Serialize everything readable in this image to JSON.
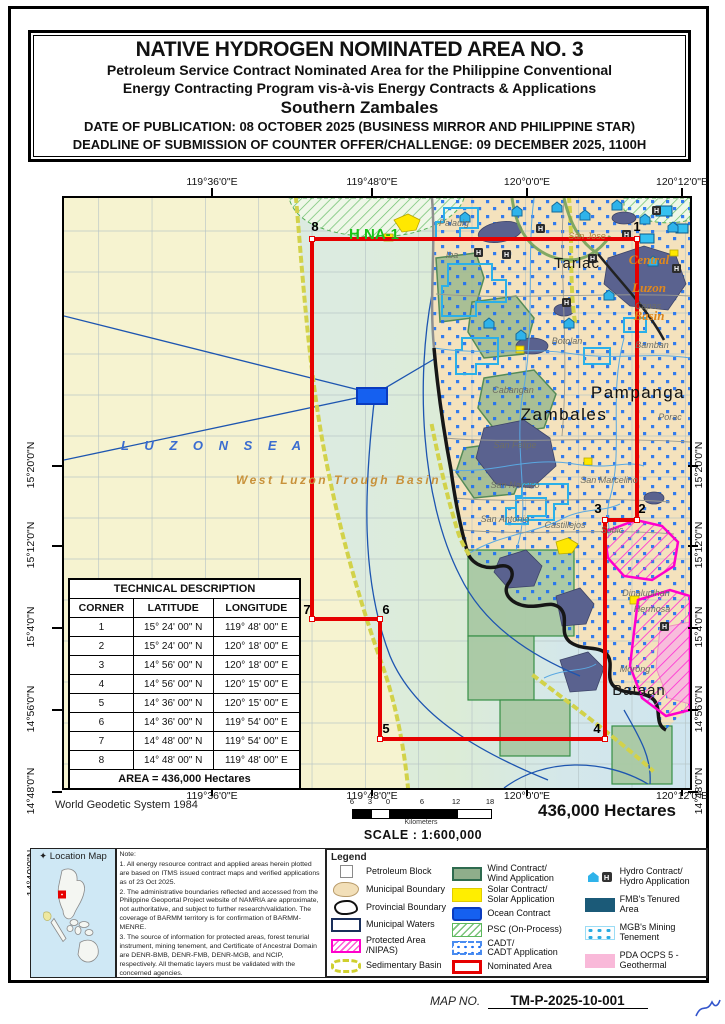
{
  "title_block": {
    "line1": "NATIVE HYDROGEN NOMINATED AREA NO. 3",
    "line2": "Petroleum Service Contract Nominated Area for the Philippine Conventional",
    "line3": "Energy Contracting Program vis-à-vis Energy Contracts & Applications",
    "line4": "Southern Zambales",
    "line5": "DATE OF PUBLICATION: 08 OCTOBER 2025 (BUSINESS MIRROR AND PHILIPPINE STAR)",
    "line6": "DEADLINE OF SUBMISSION OF COUNTER OFFER/CHALLENGE: 09 DECEMBER 2025, 1100H"
  },
  "map": {
    "axis": {
      "top": [
        {
          "x": 150,
          "label": "119°36'0\"E"
        },
        {
          "x": 310,
          "label": "119°48'0\"E"
        },
        {
          "x": 465,
          "label": "120°0'0\"E"
        },
        {
          "x": 620,
          "label": "120°12'0\"E"
        }
      ],
      "bottom": [
        {
          "x": 150,
          "label": "119°36'0\"E"
        },
        {
          "x": 310,
          "label": "119°48'0\"E"
        },
        {
          "x": 465,
          "label": "120°0'0\"E"
        },
        {
          "x": 620,
          "label": "120°12'0\"E"
        }
      ],
      "left": [
        {
          "y": 270,
          "label": "15°20'0\"N"
        },
        {
          "y": 350,
          "label": "15°12'0\"N"
        },
        {
          "y": 432,
          "label": "15°4'0\"N"
        },
        {
          "y": 514,
          "label": "14°56'0\"N"
        },
        {
          "y": 596,
          "label": "14°48'0\"N"
        },
        {
          "y": 678,
          "label": "14°40'0\"N"
        }
      ],
      "right": [
        {
          "y": 270,
          "label": "15°20'0\"N"
        },
        {
          "y": 350,
          "label": "15°12'0\"N"
        },
        {
          "y": 432,
          "label": "15°4'0\"N"
        },
        {
          "y": 514,
          "label": "14°56'0\"N"
        },
        {
          "y": 596,
          "label": "14°48'0\"N"
        },
        {
          "y": 678,
          "label": "14°40'0\"N"
        }
      ]
    },
    "corners": [
      {
        "n": "8",
        "vx": 248,
        "vy": 41,
        "lx": 251,
        "ly": 33
      },
      {
        "n": "1",
        "vx": 573,
        "vy": 41,
        "lx": 573,
        "ly": 33
      },
      {
        "n": "2",
        "vx": 573,
        "vy": 322,
        "lx": 578,
        "ly": 315
      },
      {
        "n": "3",
        "vx": 541,
        "vy": 322,
        "lx": 534,
        "ly": 315
      },
      {
        "n": "4",
        "vx": 541,
        "vy": 541,
        "lx": 533,
        "ly": 535
      },
      {
        "n": "5",
        "vx": 316,
        "vy": 541,
        "lx": 322,
        "ly": 535
      },
      {
        "n": "6",
        "vx": 316,
        "vy": 421,
        "lx": 322,
        "ly": 416
      },
      {
        "n": "7",
        "vx": 248,
        "vy": 421,
        "lx": 243,
        "ly": 416
      }
    ],
    "labels": [
      {
        "t": "H NA-1",
        "x": 285,
        "y": 41,
        "c": "m-hna",
        "a": "start"
      },
      {
        "t": "Tarlac",
        "x": 513,
        "y": 70,
        "c": "m-province"
      },
      {
        "t": "Zambales",
        "x": 500,
        "y": 222,
        "c": "m-province-lg"
      },
      {
        "t": "Pampanga",
        "x": 574,
        "y": 200,
        "c": "m-province-lg"
      },
      {
        "t": "Bataan",
        "x": 575,
        "y": 497,
        "c": "m-province"
      },
      {
        "t": "Central",
        "x": 585,
        "y": 66,
        "c": "m-basin"
      },
      {
        "t": "Luzon",
        "x": 585,
        "y": 94,
        "c": "m-basin"
      },
      {
        "t": "Basin",
        "x": 585,
        "y": 122,
        "c": "m-basin"
      },
      {
        "t": "L U Z O N   S E A",
        "x": 57,
        "y": 252,
        "c": "m-sea",
        "a": "start"
      },
      {
        "t": "West Luzon Trough Basin",
        "x": 172,
        "y": 286,
        "c": "m-trough",
        "a": "start"
      },
      {
        "t": "San Jose",
        "x": 523,
        "y": 41,
        "c": "m-town-tan"
      },
      {
        "t": "Capas",
        "x": 584,
        "y": 111,
        "c": "m-town"
      },
      {
        "t": "Bamban",
        "x": 588,
        "y": 150,
        "c": "m-town"
      },
      {
        "t": "Palauig",
        "x": 390,
        "y": 28,
        "c": "m-town"
      },
      {
        "t": "Iba",
        "x": 388,
        "y": 60,
        "c": "m-town"
      },
      {
        "t": "Botolan",
        "x": 503,
        "y": 146,
        "c": "m-town"
      },
      {
        "t": "Cabangan",
        "x": 449,
        "y": 195,
        "c": "m-town"
      },
      {
        "t": "San Felipe",
        "x": 451,
        "y": 250,
        "c": "m-town"
      },
      {
        "t": "San Narciso",
        "x": 451,
        "y": 290,
        "c": "m-town"
      },
      {
        "t": "San Antonio",
        "x": 441,
        "y": 324,
        "c": "m-town"
      },
      {
        "t": "Castillejos",
        "x": 501,
        "y": 330,
        "c": "m-town"
      },
      {
        "t": "San Marcelino",
        "x": 545,
        "y": 285,
        "c": "m-town"
      },
      {
        "t": "Porac",
        "x": 606,
        "y": 222,
        "c": "m-town"
      },
      {
        "t": "Subic",
        "x": 548,
        "y": 335,
        "c": "m-town"
      },
      {
        "t": "Dinalupihan",
        "x": 582,
        "y": 398,
        "c": "m-town"
      },
      {
        "t": "Hermosa",
        "x": 588,
        "y": 414,
        "c": "m-town"
      },
      {
        "t": "Morong",
        "x": 571,
        "y": 474,
        "c": "m-town"
      }
    ]
  },
  "technical_description": {
    "title": "TECHNICAL DESCRIPTION",
    "headers": [
      "CORNER",
      "LATITUDE",
      "LONGITUDE"
    ],
    "rows": [
      [
        "1",
        "15° 24' 00\" N",
        "119° 48' 00\" E"
      ],
      [
        "2",
        "15° 24' 00\" N",
        "120° 18' 00\" E"
      ],
      [
        "3",
        "14° 56' 00\" N",
        "120° 18' 00\" E"
      ],
      [
        "4",
        "14° 56' 00\" N",
        "120° 15' 00\" E"
      ],
      [
        "5",
        "14° 36' 00\" N",
        "120° 15' 00\" E"
      ],
      [
        "6",
        "14° 36' 00\" N",
        "119° 54' 00\" E"
      ],
      [
        "7",
        "14° 48' 00\" N",
        "119° 54' 00\" E"
      ],
      [
        "8",
        "14° 48' 00\" N",
        "119° 48' 00\" E"
      ]
    ],
    "area_label": "AREA =  436,000  Hectares"
  },
  "datum": "World Geodetic System 1984",
  "scale": {
    "tick_labels": [
      "6",
      "3",
      "0",
      "6",
      "12",
      "18"
    ],
    "tick_xs": [
      0,
      18,
      36,
      70,
      104,
      138
    ],
    "segments": [
      {
        "w": 18,
        "f": "#000"
      },
      {
        "w": 18,
        "f": "#fff"
      },
      {
        "w": 34,
        "f": "#000"
      },
      {
        "w": 34,
        "f": "#000"
      },
      {
        "w": 34,
        "f": "#fff"
      }
    ],
    "unit": "Kilometers",
    "text": "SCALE : 1:600,000"
  },
  "hectares": "436,000 Hectares",
  "location_map": {
    "title": "Location Map"
  },
  "notes": {
    "heading": "Note:",
    "items": [
      "1.  All energy resource contract and applied areas herein plotted are based on ITMS issued contract maps and verified applications as of  23 Oct 2025.",
      "2. The administrative boundaries reflected and accessed from  the Philippine Geoportal Project website of NAMRIA  are approximate, not authoritative, and subject to further research/validation. The coverage of BARMM territory is for confirmation of BARMM-MENRE.",
      "3. The source of information for protected areas, forest tenurial instrument, mining tenement, and Certificate of Ancestral Domain are DENR-BMB, DENR-FMB, DENR-MGB, and NCIP, respectively. All thematic layers must be validated with the concerned agencies."
    ]
  },
  "legend": {
    "title": "Legend",
    "columns": [
      [
        {
          "swatch": "petroleum-block",
          "label": "Petroleum Block"
        },
        {
          "swatch": "municipal-boundary",
          "label": "Municipal Boundary"
        },
        {
          "swatch": "provincial-boundary",
          "label": "Provincial  Boundary"
        },
        {
          "swatch": "municipal-waters",
          "label": "Municipal Waters"
        },
        {
          "swatch": "protected-area",
          "label": "Protected Area\n/NIPAS)"
        },
        {
          "swatch": "sedimentary-basin",
          "label": "Sedimentary Basin"
        }
      ],
      [
        {
          "swatch": "wind",
          "label": "Wind Contract/\nWind Application"
        },
        {
          "swatch": "solar",
          "label": "Solar Contract/\nSolar Application"
        },
        {
          "swatch": "ocean",
          "label": "Ocean Contract"
        },
        {
          "swatch": "psc",
          "label": "PSC (On-Process)"
        },
        {
          "swatch": "cadt",
          "label": "CADT/\nCADT Application"
        },
        {
          "swatch": "nominated",
          "label": "Nominated Area"
        }
      ],
      [
        {
          "swatch": "hydro",
          "label": "Hydro Contract/\nHydro Application"
        },
        {
          "swatch": "fmb",
          "label": "FMB's Tenured\nArea"
        },
        {
          "swatch": "mgb",
          "label": "MGB's Mining\nTenement"
        },
        {
          "swatch": "pda",
          "label": "PDA OCPS 5 -\nGeothermal"
        }
      ]
    ]
  },
  "footer": {
    "map_no_label": "MAP NO.",
    "map_no_value": "TM-P-2025-10-001"
  },
  "colors": {
    "nominated_red": "#e60000",
    "land_tan": "#f4e2bd",
    "sea_blue": "#cfe5ef",
    "basin_yellow": "#f6f3d0",
    "cadt_blue": "#1d6ff2",
    "protected_magenta": "#ff00cc",
    "geothermal_pink": "#f9b9d9",
    "fmb_slate": "#5a628f",
    "mgb_cyan": "#29abe2"
  }
}
